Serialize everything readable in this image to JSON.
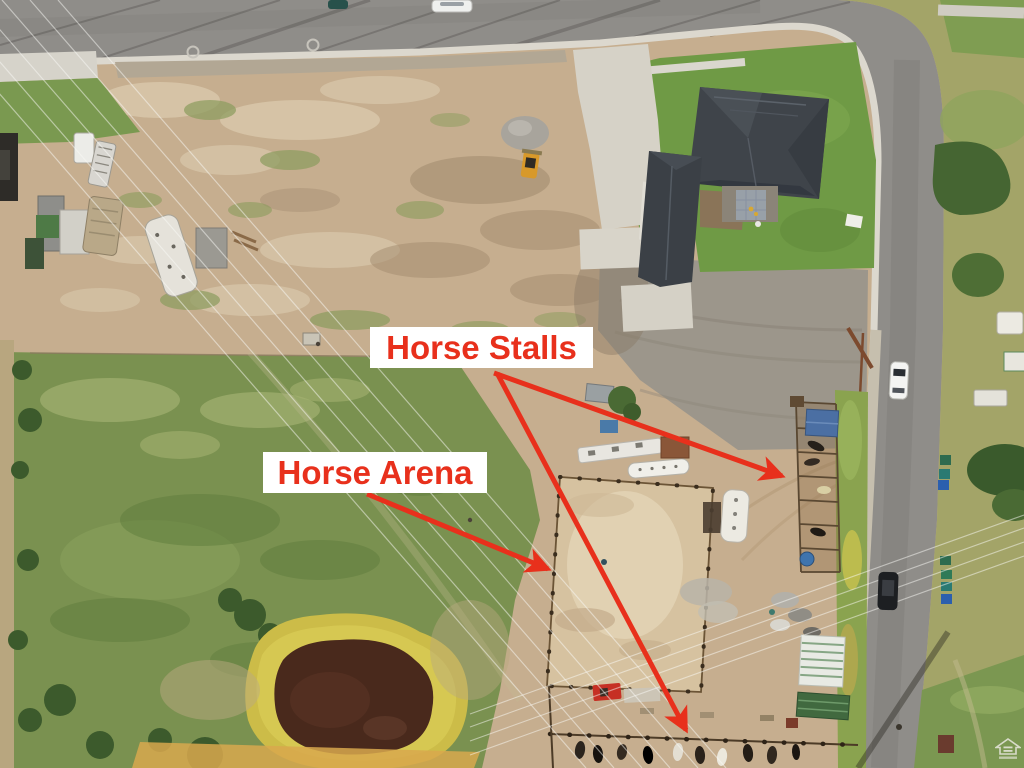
{
  "scene": {
    "type": "annotated-aerial-photo",
    "subject": "drone aerial view of a horse property with dirt lot, home, pasture, pond, horse arena and horse stalls",
    "annotations": {
      "horse_stalls": {
        "label": "Horse Stalls",
        "arrow_targets": [
          "east stall row",
          "south stall row"
        ]
      },
      "horse_arena": {
        "label": "Horse Arena",
        "arrow_targets": [
          "fenced dirt arena"
        ]
      }
    },
    "annotation_color": "#e8301c",
    "label_background": "#ffffff",
    "visible_features": [
      "curved asphalt road top",
      "side road right",
      "house with dark roof",
      "concrete driveway",
      "vacant dirt lot",
      "green pasture",
      "pond with yellow reed ring",
      "horse arena",
      "horse stall rows with horses",
      "power lines",
      "white car",
      "black car",
      "trash bins",
      "skid-steer loader",
      "gravel pile",
      "RVs and trailers",
      "sheds"
    ],
    "palette": {
      "dirt": "#c6ae8f",
      "road": "#8f8d89",
      "pasture": "#7a9150",
      "arena_sand": "#d8c4a2",
      "pond_water": "#49291c",
      "pond_ring": "#ccbc48",
      "roof": "#3f444a",
      "lawn": "#6f9a45"
    }
  },
  "watermark": {
    "icon": "equal-housing-logo"
  }
}
